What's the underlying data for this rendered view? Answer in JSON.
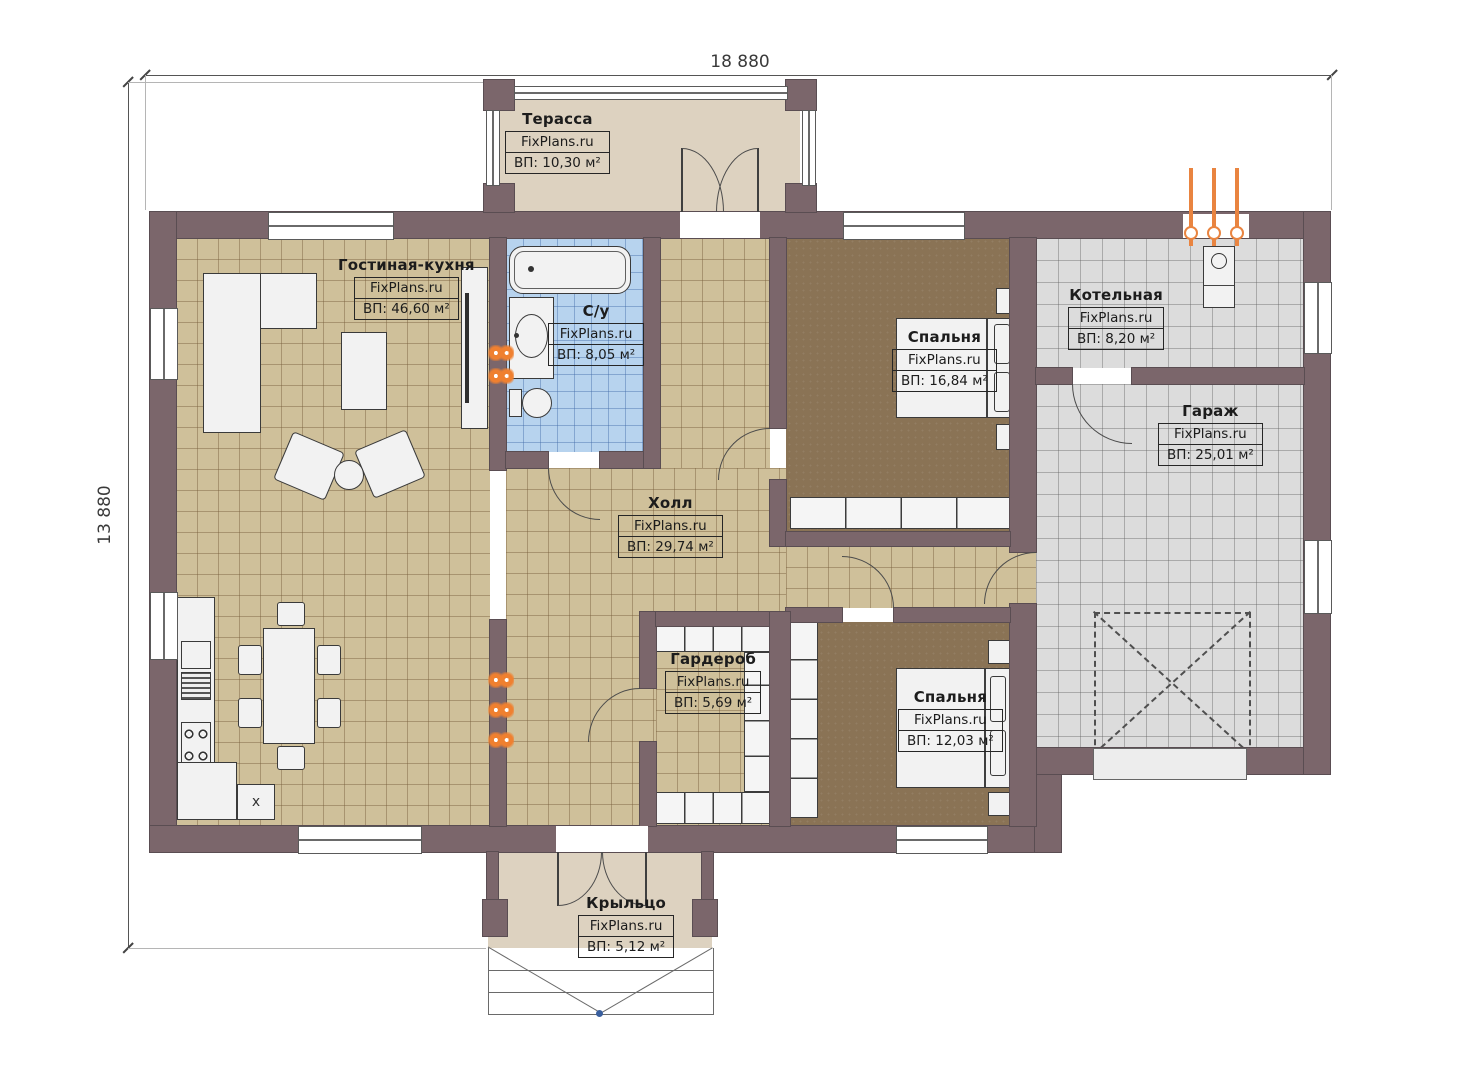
{
  "dimensions": {
    "width_label": "18 880",
    "height_label": "13 880"
  },
  "brand": "FixPlans.ru",
  "rooms": [
    {
      "id": "terrace",
      "name": "Терасса",
      "brand": "FixPlans.ru",
      "area": "ВП: 10,30 м²"
    },
    {
      "id": "living-kitchen",
      "name": "Гостиная-кухня",
      "brand": "FixPlans.ru",
      "area": "ВП: 46,60 м²"
    },
    {
      "id": "bathroom",
      "name": "С/у",
      "brand": "FixPlans.ru",
      "area": "ВП: 8,05 м²"
    },
    {
      "id": "hall",
      "name": "Холл",
      "brand": "FixPlans.ru",
      "area": "ВП: 29,74 м²"
    },
    {
      "id": "bedroom-1",
      "name": "Спальня",
      "brand": "FixPlans.ru",
      "area": "ВП: 16,84 м²"
    },
    {
      "id": "boiler-room",
      "name": "Котельная",
      "brand": "FixPlans.ru",
      "area": "ВП: 8,20 м²"
    },
    {
      "id": "garage",
      "name": "Гараж",
      "brand": "FixPlans.ru",
      "area": "ВП: 25,01 м²"
    },
    {
      "id": "wardrobe",
      "name": "Гардероб",
      "brand": "FixPlans.ru",
      "area": "ВП: 5,69 м²"
    },
    {
      "id": "bedroom-2",
      "name": "Спальня",
      "brand": "FixPlans.ru",
      "area": "ВП: 12,03 м²"
    },
    {
      "id": "porch",
      "name": "Крыльцо",
      "brand": "FixPlans.ru",
      "area": "ВП: 5,12 м²"
    }
  ],
  "kitchen": {
    "appliance_label": "x"
  },
  "colors": {
    "wall": "#7b666b",
    "floor_tan": "#cfc09a",
    "floor_blue": "#b7d3ee",
    "floor_gray": "#dcdcdc",
    "floor_brown": "#8a7355",
    "floor_beige": "#ddd2c0",
    "radiator_accent": "#ef8030"
  }
}
